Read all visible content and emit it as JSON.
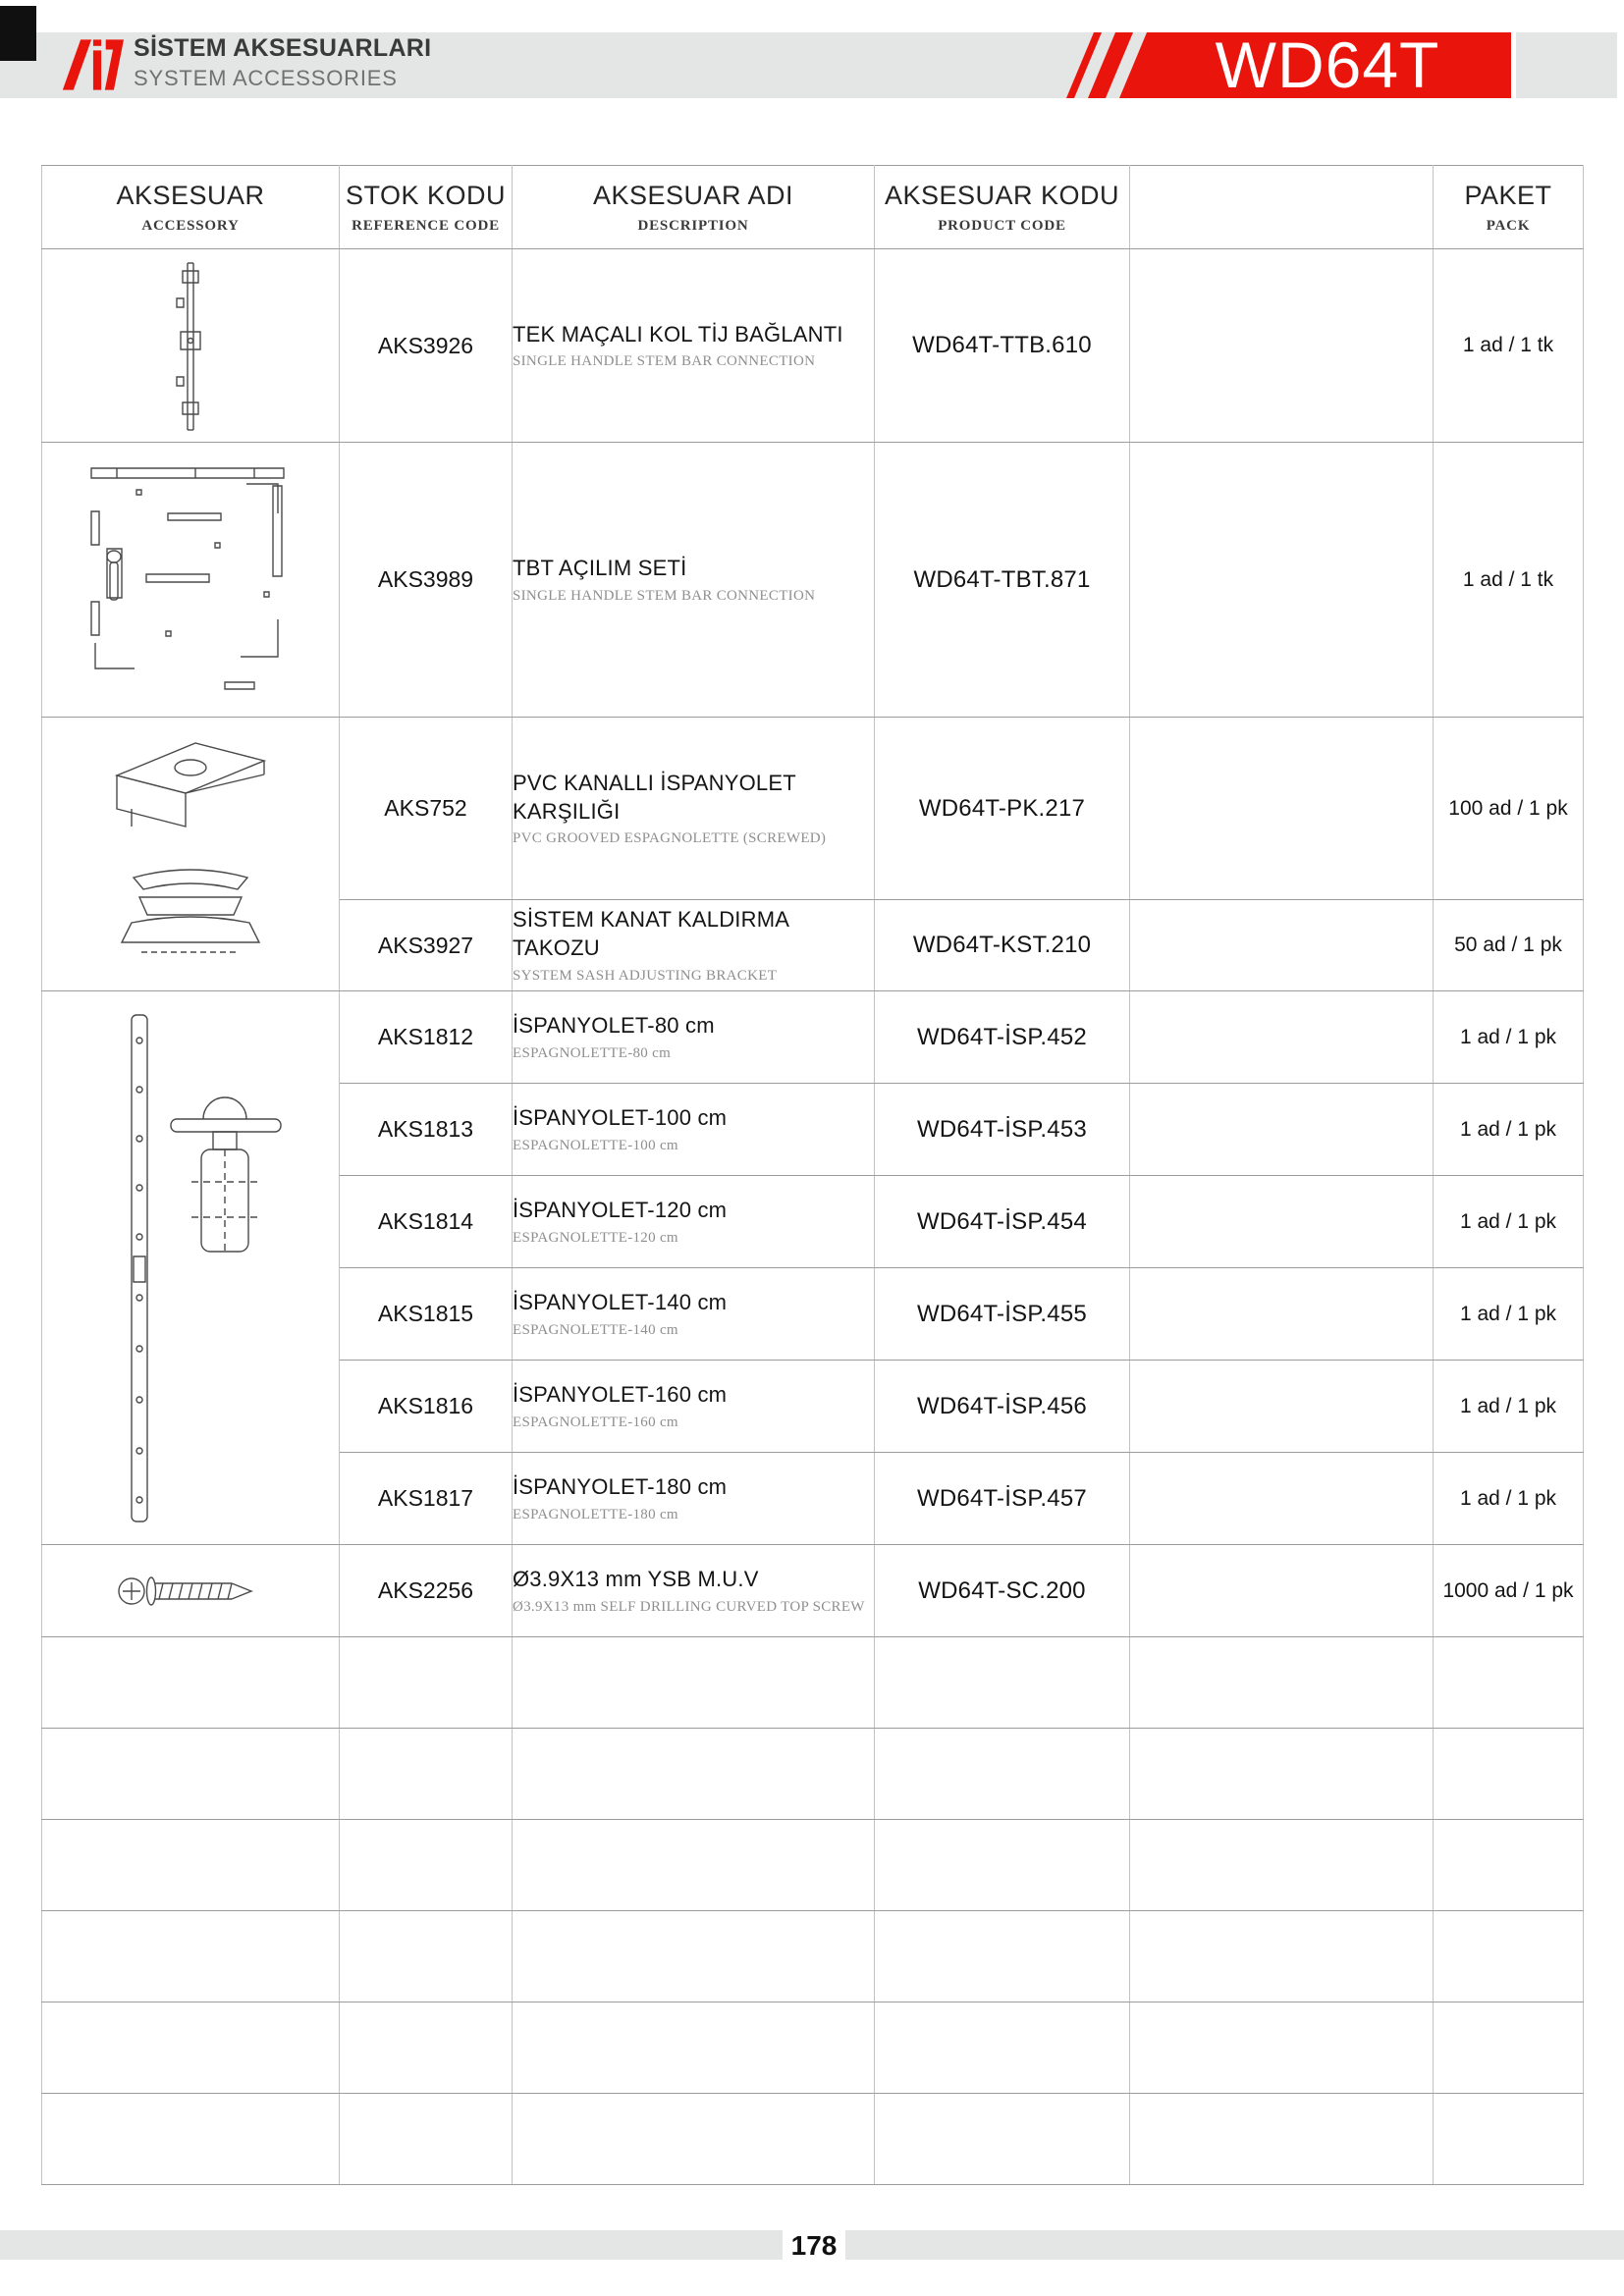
{
  "header": {
    "logo_title": "SİSTEM AKSESUARLARI",
    "logo_subtitle": "SYSTEM ACCESSORIES",
    "badge_label": "WD64T",
    "accent_red": "#e9150d",
    "bar_gray": "#e4e6e5"
  },
  "table": {
    "columns": [
      {
        "title": "AKSESUAR",
        "subtitle": "ACCESSORY"
      },
      {
        "title": "STOK KODU",
        "subtitle": "REFERENCE CODE"
      },
      {
        "title": "AKSESUAR ADI",
        "subtitle": "DESCRIPTION"
      },
      {
        "title": "AKSESUAR KODU",
        "subtitle": "PRODUCT CODE"
      },
      {
        "title": "",
        "subtitle": ""
      },
      {
        "title": "PAKET",
        "subtitle": "PACK"
      }
    ],
    "rows": [
      {
        "ref": "AKS3926",
        "title": "TEK MAÇALI KOL TİJ BAĞLANTI",
        "subtitle": "SINGLE HANDLE STEM BAR CONNECTION",
        "code": "WD64T-TTB.610",
        "pack": "1 ad / 1 tk",
        "image": "single-handle-stem-bar-drawing"
      },
      {
        "ref": "AKS3989",
        "title": "TBT AÇILIM SETİ",
        "subtitle": "SINGLE HANDLE STEM BAR CONNECTION",
        "code": "WD64T-TBT.871",
        "pack": "1 ad / 1 tk",
        "image": "tilt-turn-set-drawing"
      },
      {
        "ref": "AKS752",
        "title": "PVC KANALLI İSPANYOLET KARŞILIĞI",
        "subtitle": "PVC GROOVED ESPAGNOLETTE (SCREWED)",
        "code": "WD64T-PK.217",
        "pack": "100 ad / 1 pk",
        "image": "espagnolette-striker-drawing"
      },
      {
        "ref": "AKS3927",
        "title": "SİSTEM KANAT KALDIRMA TAKOZU",
        "subtitle": "SYSTEM SASH ADJUSTING BRACKET",
        "code": "WD64T-KST.210",
        "pack": "50 ad / 1 pk",
        "image": "sash-adjusting-bracket-drawing"
      },
      {
        "ref": "AKS1812",
        "title": "İSPANYOLET-80 cm",
        "subtitle": "ESPAGNOLETTE-80 cm",
        "code": "WD64T-İSP.452",
        "pack": "1 ad / 1 pk",
        "image": "espagnolette-bar-drawing"
      },
      {
        "ref": "AKS1813",
        "title": "İSPANYOLET-100 cm",
        "subtitle": "ESPAGNOLETTE-100 cm",
        "code": "WD64T-İSP.453",
        "pack": "1 ad / 1 pk"
      },
      {
        "ref": "AKS1814",
        "title": "İSPANYOLET-120 cm",
        "subtitle": "ESPAGNOLETTE-120 cm",
        "code": "WD64T-İSP.454",
        "pack": "1 ad / 1 pk"
      },
      {
        "ref": "AKS1815",
        "title": "İSPANYOLET-140 cm",
        "subtitle": "ESPAGNOLETTE-140 cm",
        "code": "WD64T-İSP.455",
        "pack": "1 ad / 1 pk"
      },
      {
        "ref": "AKS1816",
        "title": "İSPANYOLET-160 cm",
        "subtitle": "ESPAGNOLETTE-160 cm",
        "code": "WD64T-İSP.456",
        "pack": "1 ad / 1 pk"
      },
      {
        "ref": "AKS1817",
        "title": "İSPANYOLET-180 cm",
        "subtitle": "ESPAGNOLETTE-180 cm",
        "code": "WD64T-İSP.457",
        "pack": "1 ad / 1 pk"
      },
      {
        "ref": "AKS2256",
        "title": "Ø3.9X13 mm YSB M.U.V",
        "subtitle": "Ø3.9X13 mm SELF DRILLING CURVED TOP SCREW",
        "code": "WD64T-SC.200",
        "pack": "1000 ad / 1 pk",
        "image": "self-drilling-screw-drawing"
      }
    ],
    "empty_row_count": 6
  },
  "footer": {
    "page_number": "178"
  }
}
